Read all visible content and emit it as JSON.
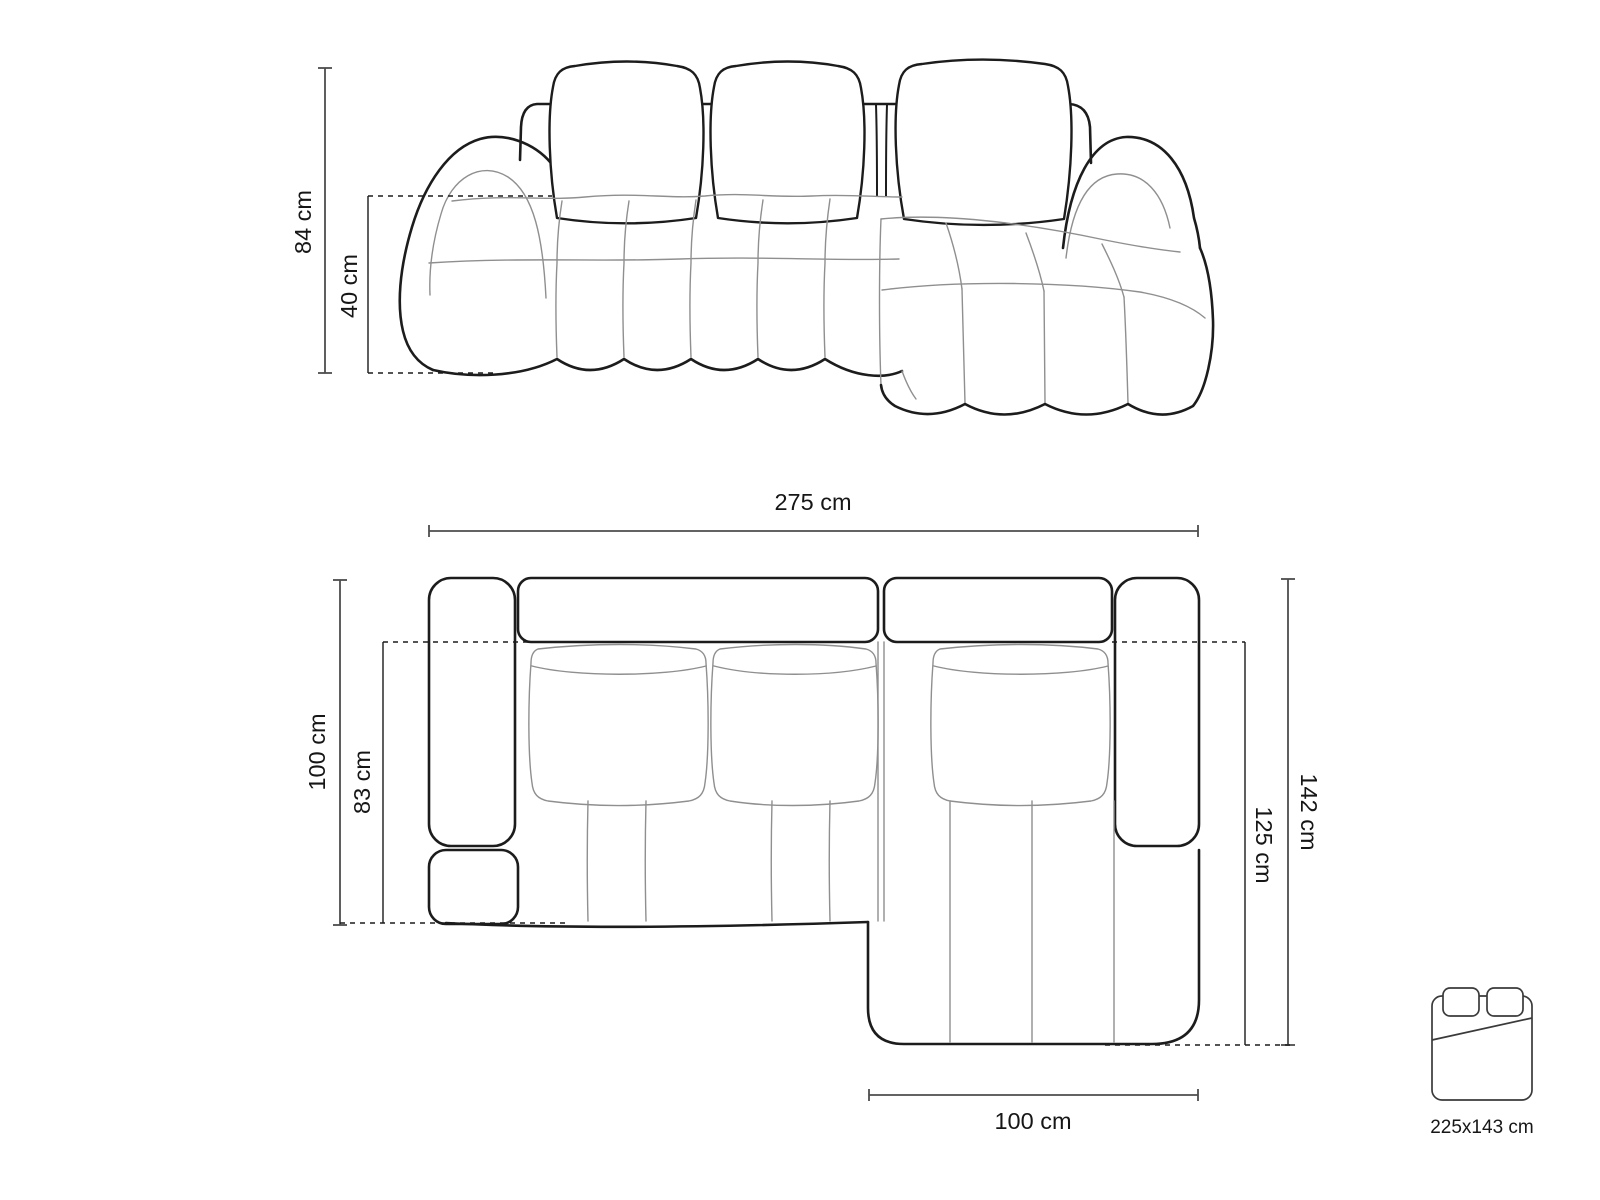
{
  "front_view": {
    "name": "sofa front elevation drawing",
    "dim_total_height": "84 cm",
    "dim_seat_height": "40 cm"
  },
  "top_view": {
    "name": "sofa top plan drawing",
    "dim_total_width": "275 cm",
    "dim_total_depth": "100 cm",
    "dim_seat_depth": "83 cm",
    "dim_chaise_total_depth": "142 cm",
    "dim_chaise_inner_depth": "125 cm",
    "dim_chaise_width": "100 cm"
  },
  "sleeping_area": {
    "icon": "bed-icon",
    "label": "225x143 cm"
  },
  "colors": {
    "outline_strong": "#1c1c1c",
    "outline_light": "#8f8f8f",
    "dimension_line": "#4d4d4d",
    "label_text": "#161616",
    "page_bg": "#ffffff"
  }
}
